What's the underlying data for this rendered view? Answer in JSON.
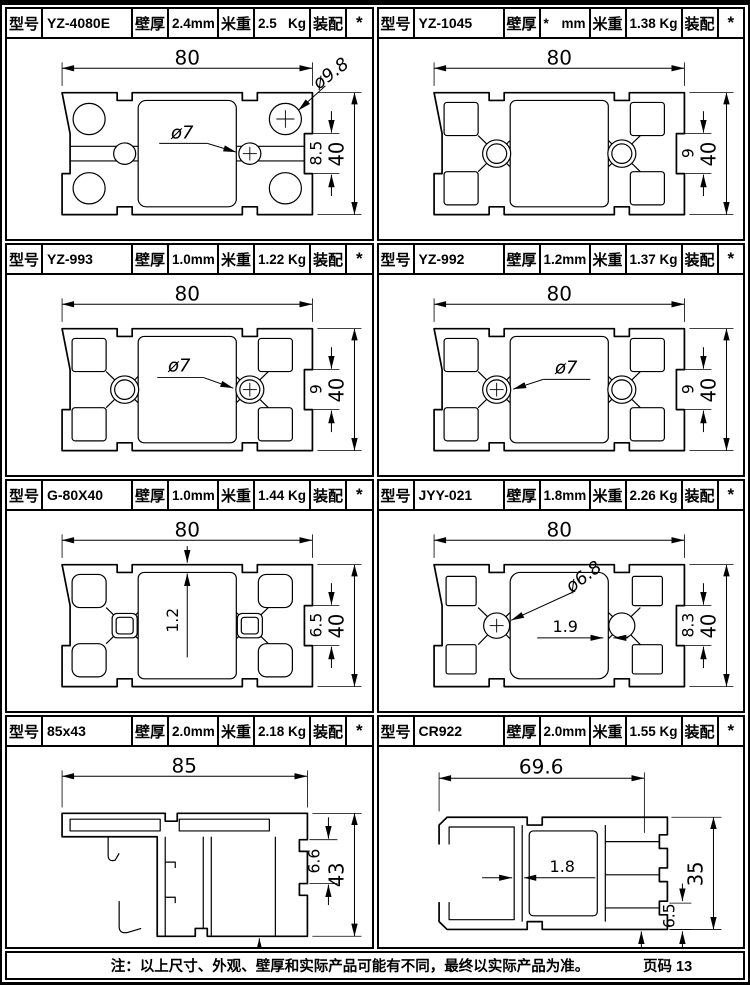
{
  "field_labels": {
    "model": "型号",
    "wall": "壁厚",
    "wall_unit": "mm",
    "weight": "米重",
    "weight_unit": "Kg",
    "assembly": "装配"
  },
  "cells": [
    {
      "model": "YZ-4080E",
      "wall": "2.4",
      "weight": "2.5",
      "assembly": "*",
      "dims": {
        "width": "80",
        "height": "40",
        "slot": "8.5",
        "hole_corner": "ø9.8",
        "hole_center": "ø7"
      }
    },
    {
      "model": "YZ-1045",
      "wall": "*",
      "weight": "1.38",
      "assembly": "*",
      "dims": {
        "width": "80",
        "height": "40",
        "slot": "9"
      }
    },
    {
      "model": "YZ-993",
      "wall": "1.0",
      "weight": "1.22",
      "assembly": "*",
      "dims": {
        "width": "80",
        "height": "40",
        "slot": "9",
        "hole_center": "ø7"
      }
    },
    {
      "model": "YZ-992",
      "wall": "1.2",
      "weight": "1.37",
      "assembly": "*",
      "dims": {
        "width": "80",
        "height": "40",
        "slot": "9",
        "hole_center": "ø7"
      }
    },
    {
      "model": "G-80X40",
      "wall": "1.0",
      "weight": "1.44",
      "assembly": "*",
      "dims": {
        "width": "80",
        "height": "40",
        "slot": "6.5",
        "wall_callout": "1.2"
      }
    },
    {
      "model": "JYY-021",
      "wall": "1.8",
      "weight": "2.26",
      "assembly": "*",
      "dims": {
        "width": "80",
        "height": "40",
        "slot": "8.3",
        "hole_center": "ø6.8",
        "wall_callout": "1.9"
      }
    },
    {
      "model": "85x43",
      "wall": "2.0",
      "weight": "2.18",
      "assembly": "*",
      "dims": {
        "width": "85",
        "height": "43",
        "slot": "6.6"
      }
    },
    {
      "model": "CR922",
      "wall": "2.0",
      "weight": "1.55",
      "assembly": "*",
      "dims": {
        "width": "69.6",
        "height": "35",
        "slot": "6.5",
        "wall_callout": "1.8"
      }
    }
  ],
  "footer": {
    "note": "注：以上尺寸、外观、壁厚和实际产品可能有不同，最终以实际产品为准。",
    "page_label": "页码 13"
  }
}
